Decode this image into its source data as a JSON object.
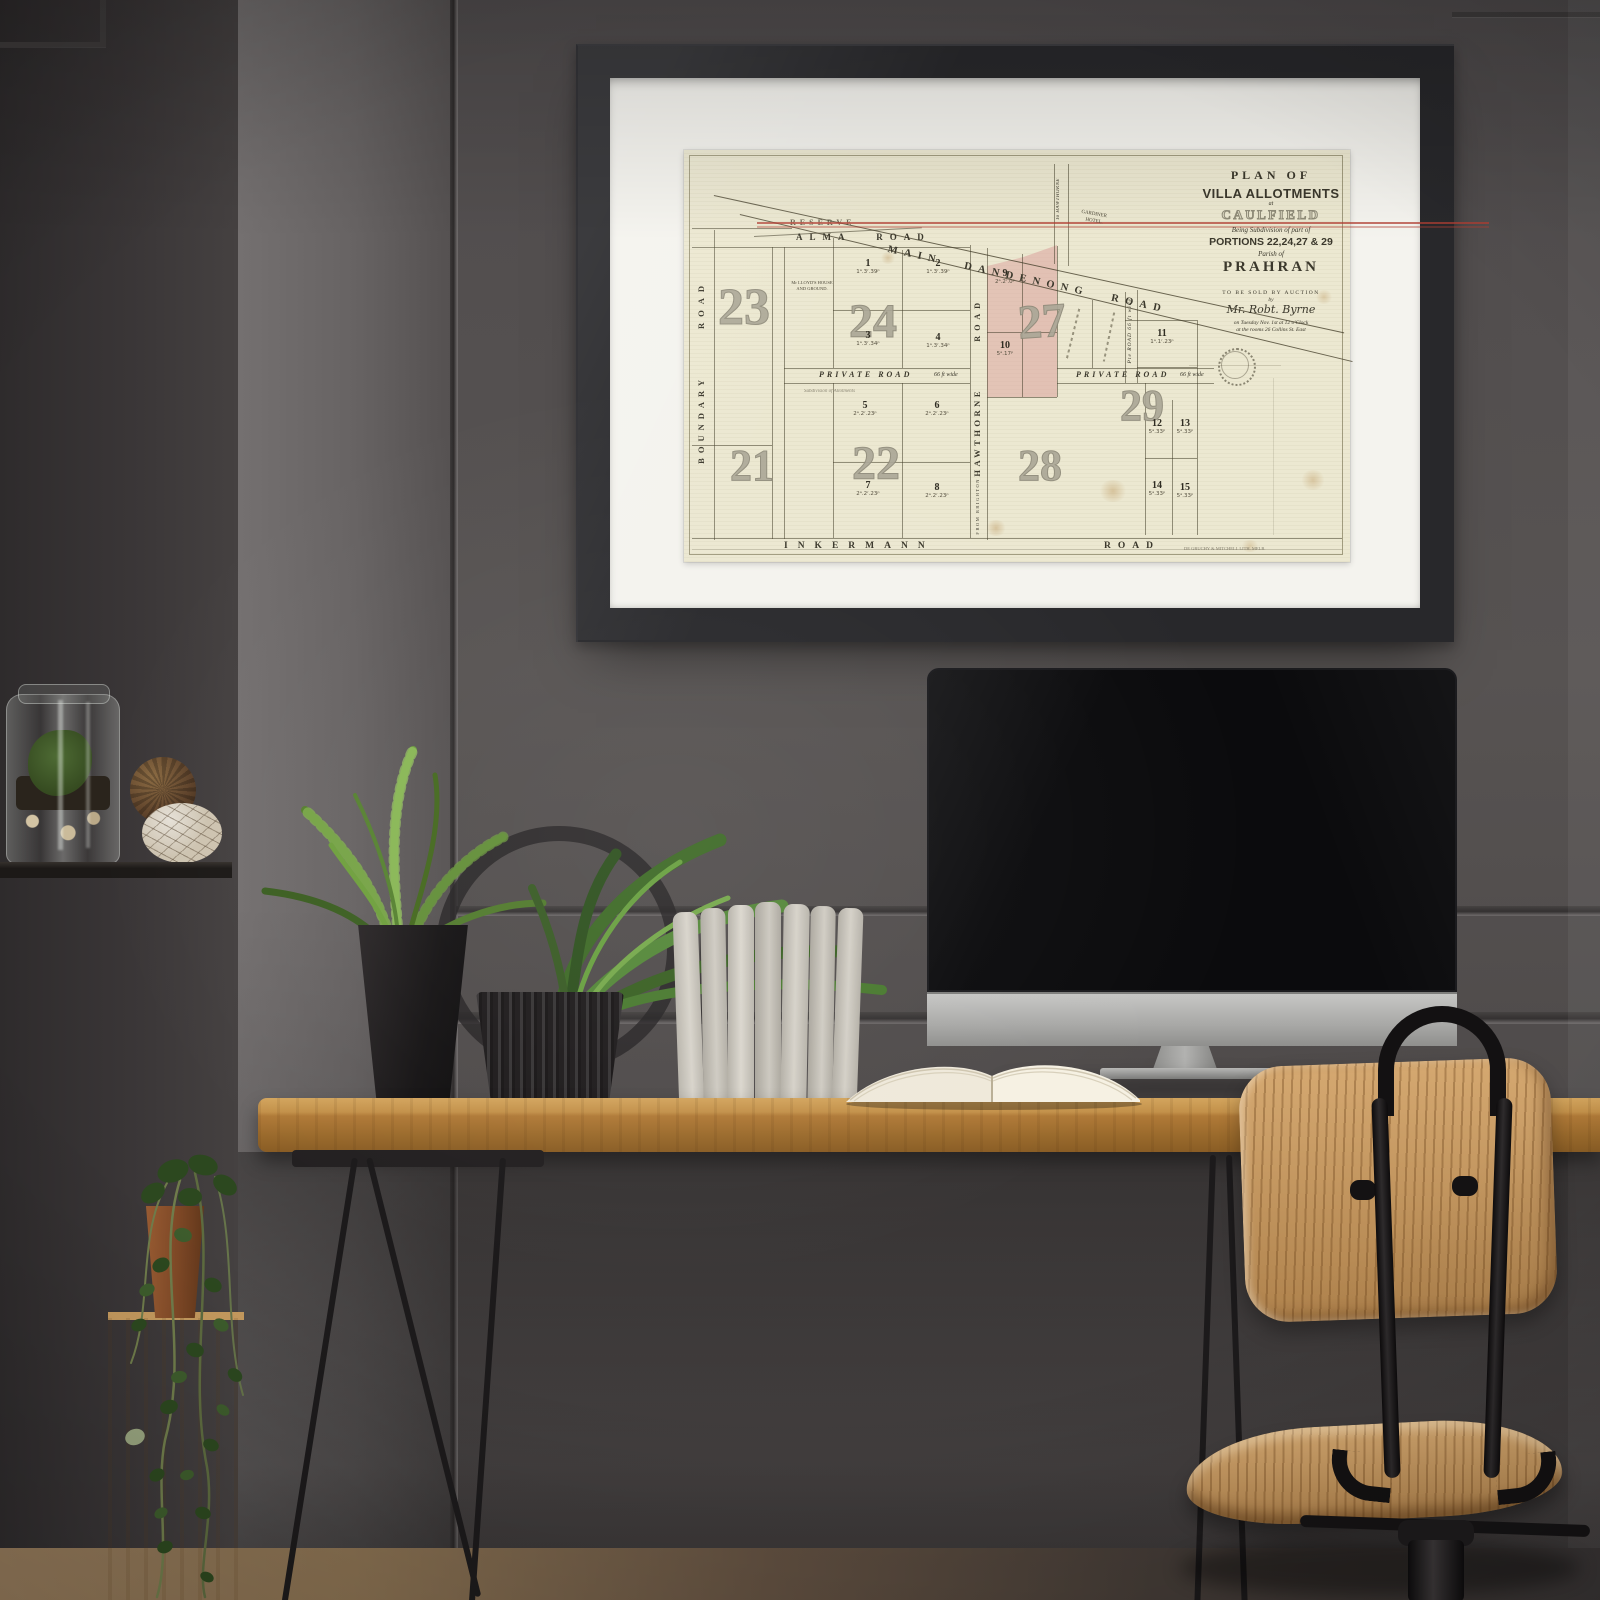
{
  "palette": {
    "wall": "#54504f",
    "wall_dark": "#35322f",
    "frame": "#28282b",
    "mat": "#f4f3ee",
    "paper": "#ece8d1",
    "lot_pink": "#dcaaa6",
    "reserve_red": "#b5443a",
    "ink": "#3a372c",
    "faded_number": "#a9a597",
    "desk_wood": "#b07c3b",
    "chair_wood": "#c79457",
    "leaf_green": "#527b2e",
    "metal_black": "#141213",
    "imac_silver": "#b3b3b1"
  },
  "map": {
    "title_block": {
      "plan_of": "PLAN OF",
      "villa_allotments": "VILLA ALLOTMENTS",
      "at": "at",
      "caulfield": "CAULFIELD",
      "being": "Being Subdivision of part of",
      "portions": "PORTIONS 22,24,27 & 29",
      "parish_of": "Parish of",
      "prahran": "PRAHRAN",
      "auction": "TO BE SOLD BY AUCTION",
      "by": "by",
      "auctioneer": "Mr. Robt. Byrne",
      "date_line": "on Tuesday Nov. 1st at 12 o'Clock",
      "rooms_line": "at the rooms 26 Collins St. East"
    },
    "roads": {
      "main_dandenong": "MAIN DANDENONG ROAD",
      "alma": "ALMA ROAD",
      "boundary_word": "BOUNDARY",
      "boundary_road_word": "ROAD",
      "inkermann": "INKERMANN",
      "inkermann_road_word": "ROAD",
      "hawthorne_road_word": "ROAD",
      "hawthorne": "HAWTHORNE",
      "from_brighton": "FROM BRIGHTON",
      "to_hawthorne": "To HAWTHORNE",
      "private_left": "PRIVATE ROAD",
      "private_left_width": "66 ft wide",
      "private_right": "PRIVATE ROAD",
      "private_right_width": "66 ft wide",
      "pte_road": "Pte ROAD 66 ft wide",
      "reserve": "RESERVE"
    },
    "labels": {
      "lloyds_1": "Mr LLOYD'S HOUSE",
      "lloyds_2": "AND GROUND.",
      "gardiner_1": "GARDINER",
      "gardiner_2": "HOTEL.",
      "subdivision_note": "Subdivision of Allotments",
      "lithographer": "DE GRUCHY & MITCHELL LITH. MELB."
    },
    "sections": {
      "s21": "21",
      "s22": "22",
      "s23": "23",
      "s24": "24",
      "s27": "27",
      "s28": "28",
      "s29": "29"
    },
    "lots": [
      {
        "number": "1",
        "size": "1ᵃ.3ʳ.39ᵖ"
      },
      {
        "number": "2",
        "size": "1ᵃ.3ʳ.39ᵖ"
      },
      {
        "number": "3",
        "size": "1ᵃ.3ʳ.34ᵖ"
      },
      {
        "number": "4",
        "size": "1ᵃ.3ʳ.34ᵖ"
      },
      {
        "number": "5",
        "size": "2ᵃ.2ʳ.23ᵖ"
      },
      {
        "number": "6",
        "size": "2ᵃ.2ʳ.23ᵖ"
      },
      {
        "number": "7",
        "size": "2ᵃ.2ʳ.23ᵖ"
      },
      {
        "number": "8",
        "size": "2ᵃ.2ʳ.23ᵖ"
      },
      {
        "number": "9",
        "size": "2ᵃ.2ʳ.0ᵖ"
      },
      {
        "number": "10",
        "size": "5ᵃ.17ᵖ"
      },
      {
        "number": "11",
        "size": "1ᵃ.1ʳ.23ᵖ"
      },
      {
        "number": "12",
        "size": "5ᵃ.33ᵖ"
      },
      {
        "number": "13",
        "size": "5ᵃ.33ᵖ"
      },
      {
        "number": "14",
        "size": "5ᵃ.33ᵖ"
      },
      {
        "number": "15",
        "size": "5ᵃ.33ᵖ"
      }
    ]
  }
}
